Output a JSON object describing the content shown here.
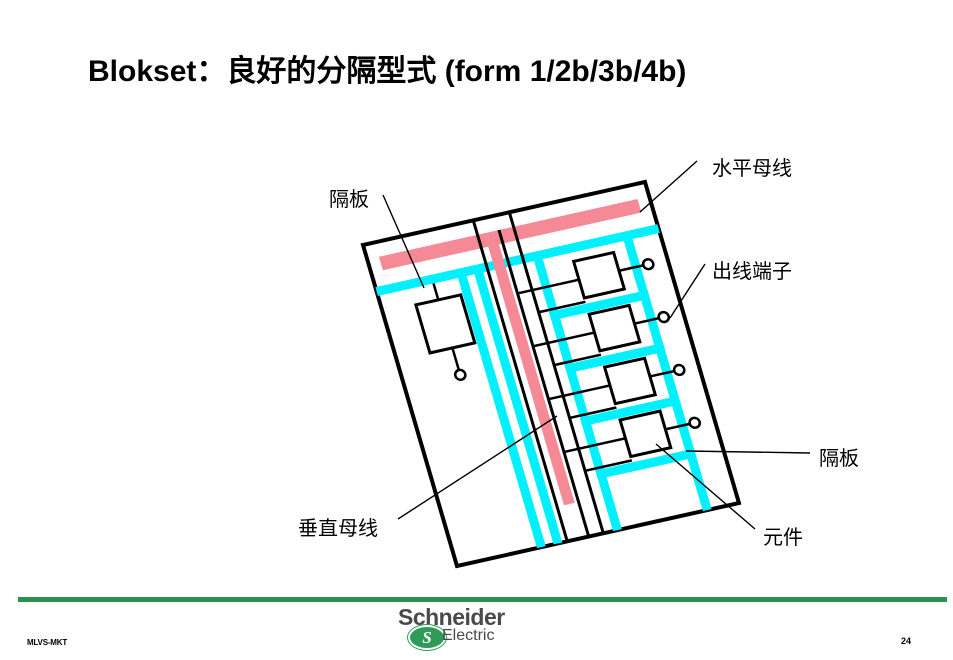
{
  "title": "Blokset：良好的分隔型式 (form 1/2b/3b/4b)",
  "diagram": {
    "labels": {
      "partition_top": "隔板",
      "horizontal_busbar": "水平母线",
      "outgoing_terminals": "出线端子",
      "partition_right": "隔板",
      "vertical_busbar": "垂直母线",
      "component": "元件"
    },
    "parts": {
      "cabinet": "tilted switchboard enclosure",
      "horizontal_busbar_color": "pink",
      "vertical_busbar_color": "pink",
      "partitions_color": "cyan",
      "feeder_cells": 4,
      "outgoing_terminal_circles": 5
    }
  },
  "colors": {
    "busbar-pink": "#F58A96",
    "partition-cyan": "#00F0FF",
    "line-black": "#000000",
    "footer-green": "#2A9150",
    "logo-green": "#2E9B57",
    "logo-gray": "#4A4A4C"
  },
  "logo": {
    "brand": "Schneider",
    "sub": "Electric",
    "s_glyph": "S"
  },
  "footer": {
    "left_code": "MLVS-MKT",
    "page_number": "24"
  }
}
